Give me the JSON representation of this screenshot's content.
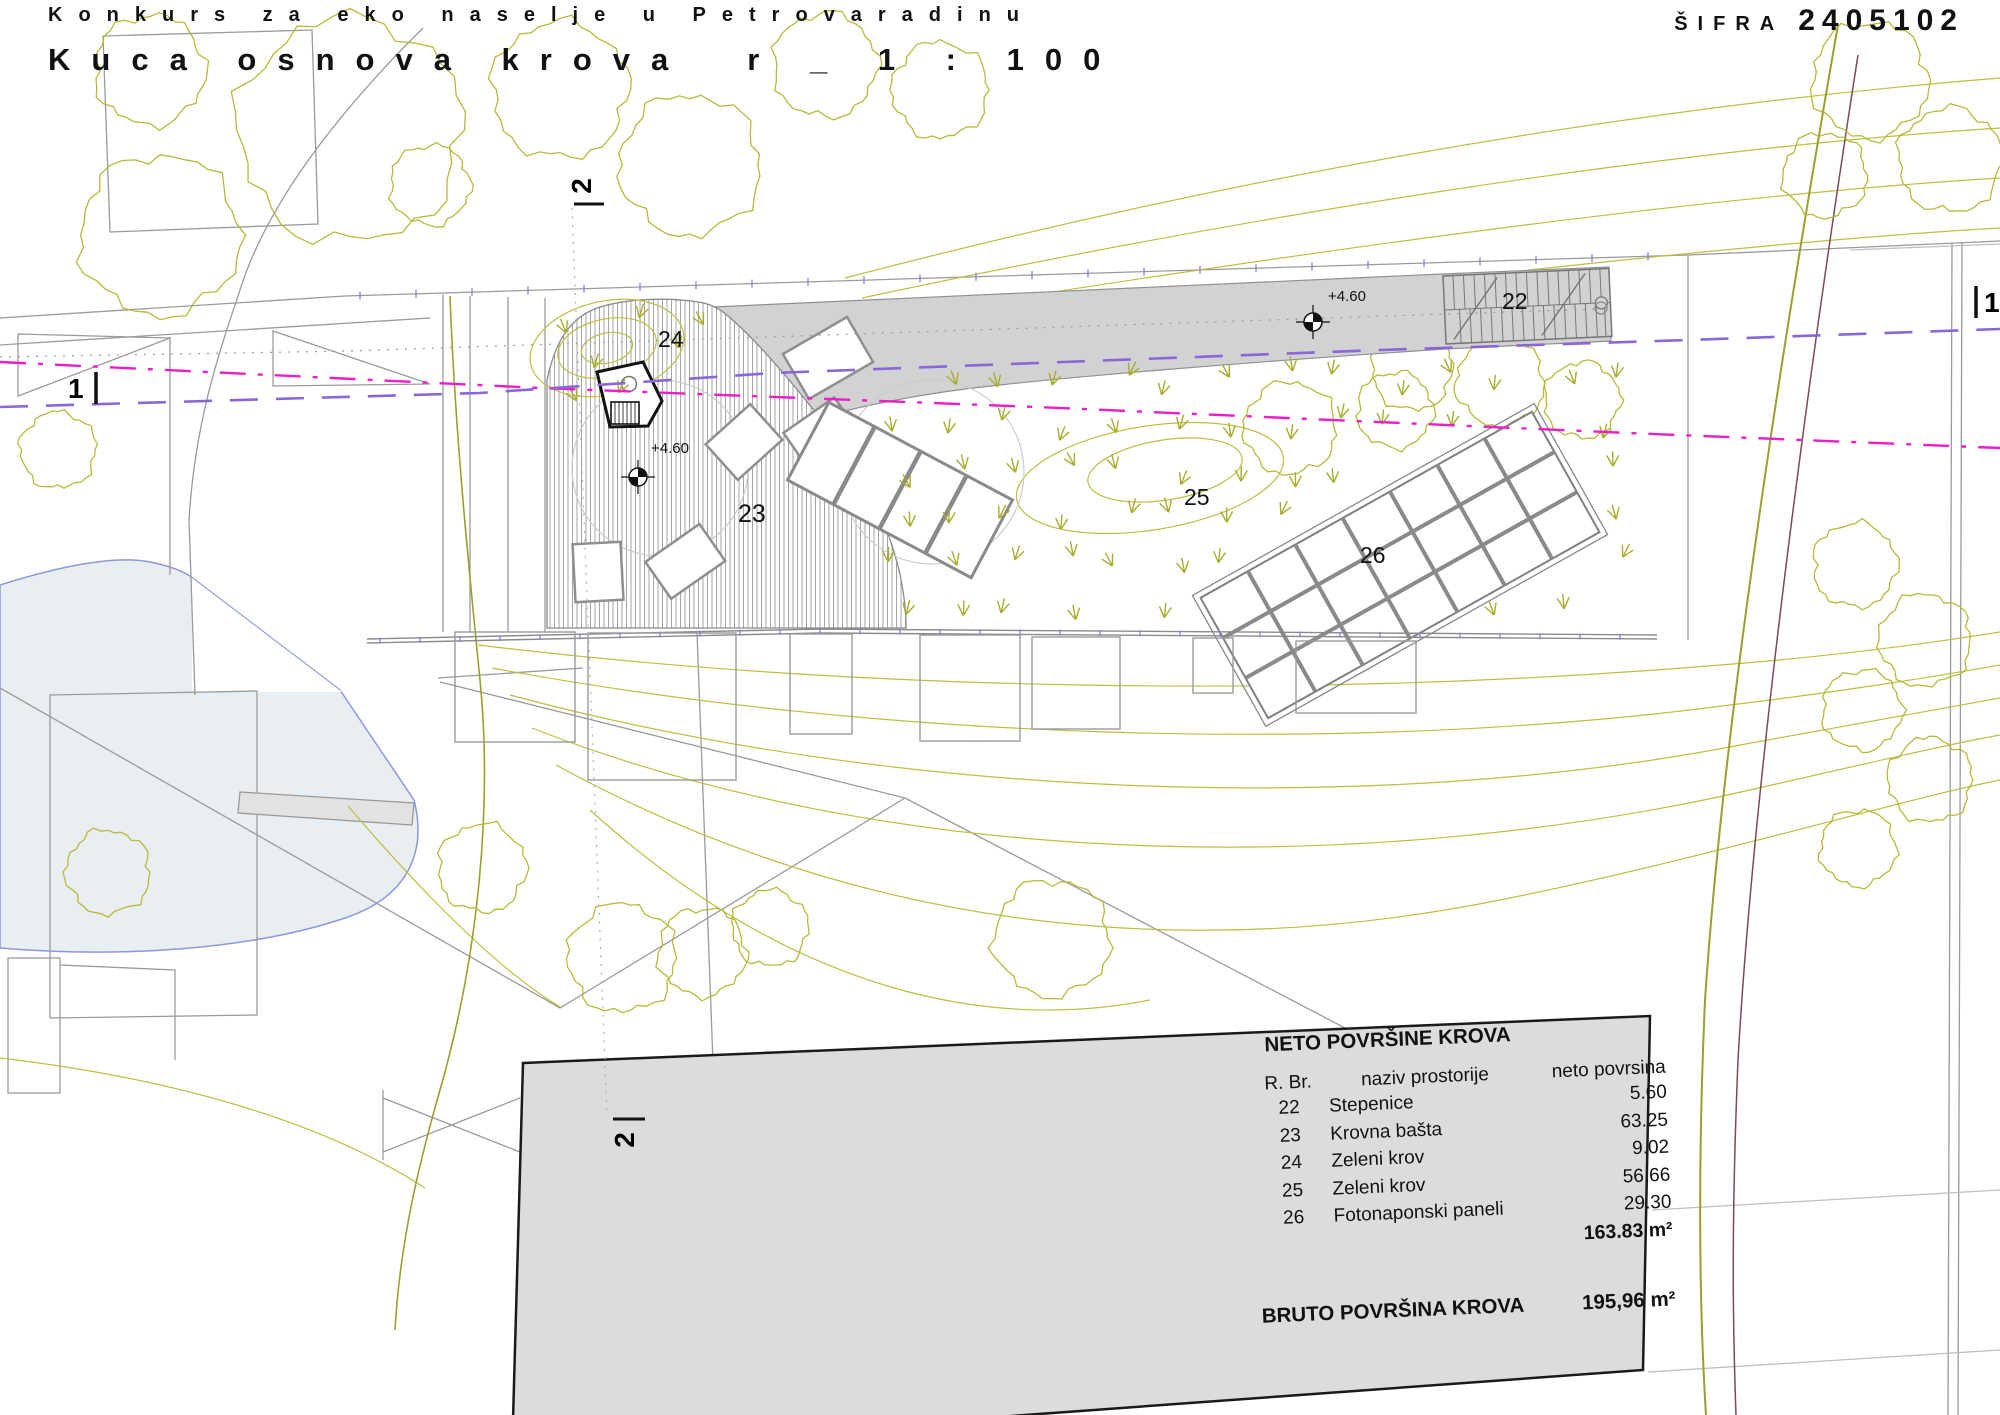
{
  "title": {
    "line1": "Konkurs za eko naselje u Petrovaradinu",
    "line2": "Kuca osnova krova",
    "scale": "r _ 1 : 100",
    "code_label": "ŠIFRA",
    "code_value": "2405102"
  },
  "plan": {
    "area_labels": [
      "22",
      "23",
      "24",
      "25",
      "26"
    ],
    "level_markers": [
      "+4.60",
      "+4.60"
    ],
    "sections": {
      "one": "1",
      "two": "2"
    }
  },
  "table": {
    "title": "NETO POVRŠINE KROVA",
    "columns": [
      "R. Br.",
      "naziv prostorije",
      "neto povrsina"
    ],
    "rows": [
      {
        "no": "22",
        "name": "Stepenice",
        "area": "5.60"
      },
      {
        "no": "23",
        "name": "Krovna bašta",
        "area": "63.25"
      },
      {
        "no": "24",
        "name": "Zeleni krov",
        "area": "9.02"
      },
      {
        "no": "25",
        "name": "Zeleni krov",
        "area": "56.66"
      },
      {
        "no": "26",
        "name": "Fotonaponski paneli",
        "area": "29.30"
      }
    ],
    "net_total": "163.83 m²",
    "bruto_label": "BRUTO POVRŠINA KROVA",
    "bruto_total": "195,96 m²"
  },
  "colors": {
    "vegetation": "#b3b72f",
    "contour": "#bcbf3f",
    "magenta_line": "#ea1fc8",
    "purple_line": "#8a66d9",
    "band_gray": "#d2d2d2",
    "panel_gray": "#dcdcdc",
    "pond_fill": "#e9eef2",
    "pond_stroke": "#8d97db"
  }
}
